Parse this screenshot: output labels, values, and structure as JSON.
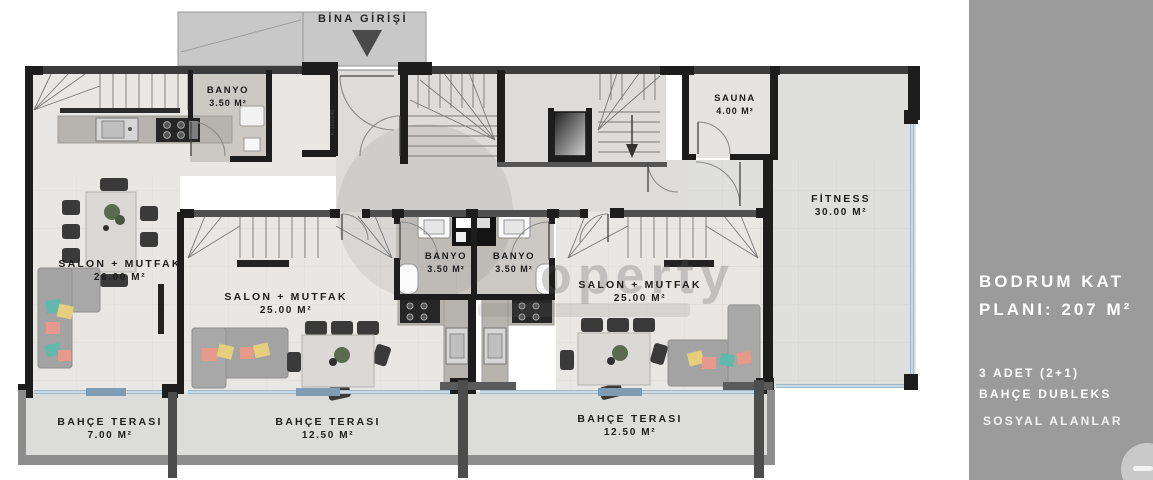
{
  "sidebar": {
    "title_line1": "BODRUM KAT",
    "title_line2": "PLANI: 207 M²",
    "info_line1": "3 ADET (2+1)",
    "info_line2": "BAHÇE DUBLEKS",
    "info_line3": "SOSYAL ALANLAR",
    "bg_color": "#9b9b9b",
    "text_color": "#ffffff"
  },
  "plan": {
    "entrance_label": "BİNA GİRİŞİ",
    "door_tag": "K-150/240",
    "watermark_text": "operty",
    "rooms": [
      {
        "id": "banyo1",
        "name": "BANYO",
        "area": "3.50 M²"
      },
      {
        "id": "sauna",
        "name": "SAUNA",
        "area": "4.00 M²"
      },
      {
        "id": "fitness",
        "name": "FİTNESS",
        "area": "30.00 M²"
      },
      {
        "id": "salon1",
        "name": "SALON + MUTFAK",
        "area": "26.00 M²"
      },
      {
        "id": "salon2",
        "name": "SALON + MUTFAK",
        "area": "25.00 M²"
      },
      {
        "id": "banyo2",
        "name": "BANYO",
        "area": "3.50 M²"
      },
      {
        "id": "banyo3",
        "name": "BANYO",
        "area": "3.50 M²"
      },
      {
        "id": "salon3",
        "name": "SALON + MUTFAK",
        "area": "25.00 M²"
      },
      {
        "id": "terrace1",
        "name": "BAHÇE TERASI",
        "area": "7.00 M²"
      },
      {
        "id": "terrace2",
        "name": "BAHÇE TERASI",
        "area": "12.50 M²"
      },
      {
        "id": "terrace3",
        "name": "BAHÇE TERASI",
        "area": "12.50 M²"
      }
    ],
    "colors": {
      "wall": "#1d1d1d",
      "glass": "#9db8cc",
      "unit_floor": "#e9e7e3",
      "terrace_wall": "#8d8d8d",
      "pillow_teal": "#62b8ac",
      "pillow_yellow": "#e5cf7d",
      "pillow_salmon": "#e59a8b"
    }
  }
}
